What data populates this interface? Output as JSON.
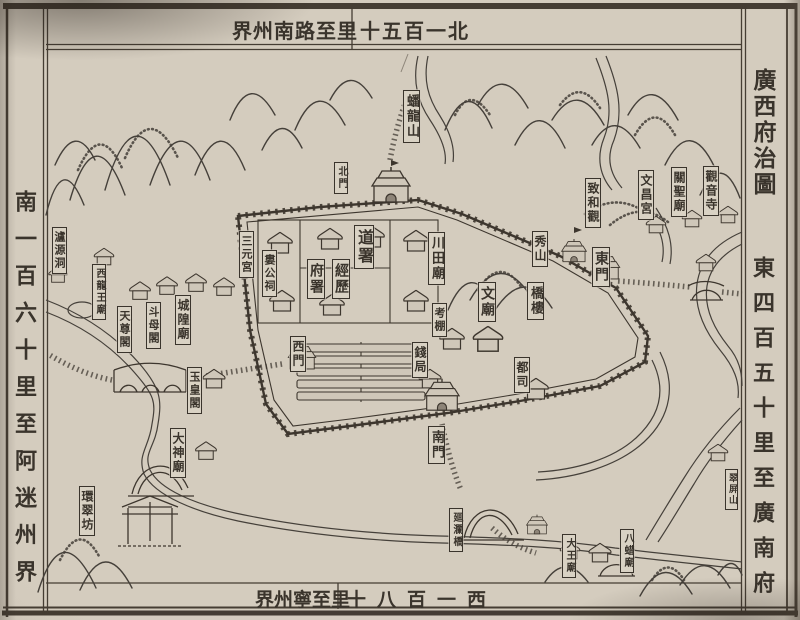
{
  "title": "廣西府治圖",
  "colors": {
    "paper": "#cfc7b9",
    "ink": "#3a342c",
    "label_bg": "#d9d2c4"
  },
  "borders": {
    "top": {
      "left_text": "界州南路至里",
      "right_text": "十五百一北"
    },
    "bottom": {
      "left_text": "界州寧至里",
      "right_text": "十八百一西"
    },
    "left": {
      "text": "南一百六十里至阿迷州界"
    },
    "right": {
      "title": "廣西府治圖",
      "text": "東四百五十里至廣南府"
    }
  },
  "map": {
    "labels": [
      {
        "id": "panlong-shan",
        "text": "蟠龍山",
        "x": 403,
        "y": 90,
        "fs": 13
      },
      {
        "id": "north-gate",
        "text": "北門",
        "x": 334,
        "y": 162,
        "fs": 10
      },
      {
        "id": "zhihe-guan",
        "text": "致和觀",
        "x": 585,
        "y": 178,
        "fs": 12
      },
      {
        "id": "wenchang-gong",
        "text": "文昌宮",
        "x": 638,
        "y": 170,
        "fs": 12
      },
      {
        "id": "guansheng-miao",
        "text": "關聖廟",
        "x": 671,
        "y": 167,
        "fs": 12
      },
      {
        "id": "guanyin-si",
        "text": "觀音寺",
        "x": 703,
        "y": 166,
        "fs": 12
      },
      {
        "id": "sanyuan-gong",
        "text": "三元宮",
        "x": 239,
        "y": 231,
        "fs": 11
      },
      {
        "id": "lougong-ci",
        "text": "婁公祠",
        "x": 262,
        "y": 250,
        "fs": 11
      },
      {
        "id": "dao-shu",
        "text": "道署",
        "x": 354,
        "y": 225,
        "fs": 16
      },
      {
        "id": "fu-shu",
        "text": "府署",
        "x": 307,
        "y": 259,
        "fs": 14
      },
      {
        "id": "jing-li",
        "text": "經歷",
        "x": 332,
        "y": 259,
        "fs": 14
      },
      {
        "id": "chuantian-miao",
        "text": "川田廟",
        "x": 428,
        "y": 232,
        "fs": 13
      },
      {
        "id": "xiu-shan",
        "text": "秀山",
        "x": 532,
        "y": 231,
        "fs": 12
      },
      {
        "id": "qiao-lou",
        "text": "橋樓",
        "x": 527,
        "y": 282,
        "fs": 13
      },
      {
        "id": "east-gate",
        "text": "東門",
        "x": 592,
        "y": 247,
        "fs": 14
      },
      {
        "id": "wen-miao",
        "text": "文廟",
        "x": 478,
        "y": 282,
        "fs": 14
      },
      {
        "id": "kao-peng",
        "text": "考棚",
        "x": 432,
        "y": 303,
        "fs": 11
      },
      {
        "id": "qian-ju",
        "text": "錢局",
        "x": 412,
        "y": 342,
        "fs": 12
      },
      {
        "id": "du-si",
        "text": "都司",
        "x": 514,
        "y": 357,
        "fs": 12
      },
      {
        "id": "west-gate",
        "text": "西門",
        "x": 290,
        "y": 336,
        "fs": 12
      },
      {
        "id": "chenghuang-miao",
        "text": "城隍廟",
        "x": 175,
        "y": 295,
        "fs": 12
      },
      {
        "id": "doumu-ge",
        "text": "斗母閣",
        "x": 146,
        "y": 302,
        "fs": 11
      },
      {
        "id": "tianzun-ge",
        "text": "天尊閣",
        "x": 117,
        "y": 306,
        "fs": 11
      },
      {
        "id": "xilongwang-miao",
        "text": "西龍王廟",
        "x": 92,
        "y": 264,
        "fs": 10
      },
      {
        "id": "luyuan-dong",
        "text": "瀘源洞",
        "x": 52,
        "y": 227,
        "fs": 11
      },
      {
        "id": "yuhuang-ge",
        "text": "玉皇閣",
        "x": 187,
        "y": 367,
        "fs": 11
      },
      {
        "id": "dashen-miao",
        "text": "大神廟",
        "x": 170,
        "y": 428,
        "fs": 12
      },
      {
        "id": "huancui-fang",
        "text": "環翠坊",
        "x": 79,
        "y": 486,
        "fs": 12
      },
      {
        "id": "south-gate",
        "text": "南門",
        "x": 428,
        "y": 426,
        "fs": 13
      },
      {
        "id": "huilan-qiao",
        "text": "廻瀾橋",
        "x": 449,
        "y": 508,
        "fs": 10
      },
      {
        "id": "dawang-miao",
        "text": "大王廟",
        "x": 562,
        "y": 534,
        "fs": 10
      },
      {
        "id": "bazha-miao",
        "text": "八蜡廟",
        "x": 620,
        "y": 529,
        "fs": 10
      },
      {
        "id": "cuiping-shan",
        "text": "翠屏山",
        "x": 725,
        "y": 469,
        "fs": 9
      }
    ]
  }
}
